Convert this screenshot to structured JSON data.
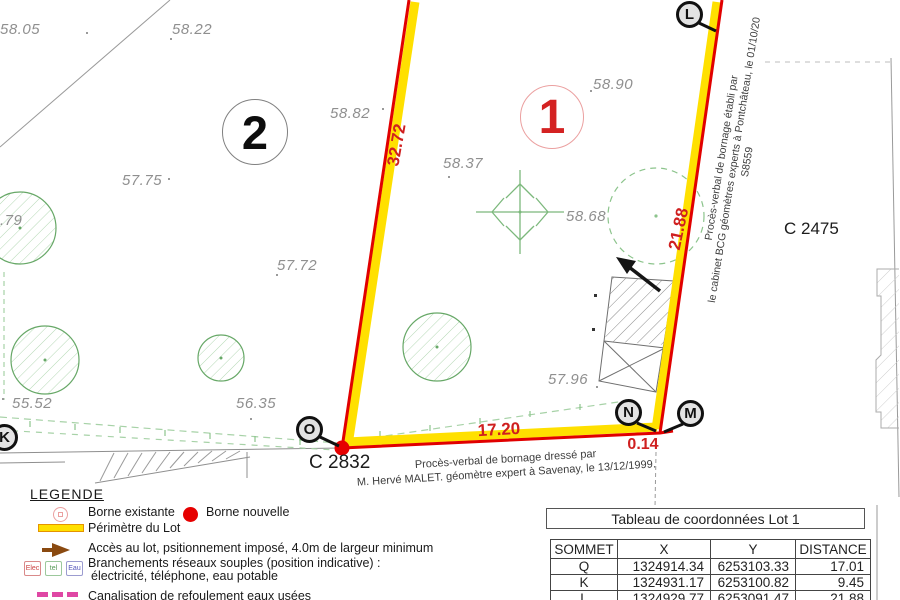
{
  "plan": {
    "lot1_label": "1",
    "lot2_label": "2",
    "parcel_right": "C 2475",
    "parcel_bottom": "C 2832",
    "dim_left": "32.72",
    "dim_right": "21.88",
    "dim_bottom": "17.20",
    "dim_corner": "0.14",
    "vertices": {
      "L": "L",
      "O": "O",
      "N": "N",
      "M": "M",
      "K": "K"
    },
    "elevations": [
      {
        "value": "58.05"
      },
      {
        "value": "58.22"
      },
      {
        "value": "58.90"
      },
      {
        "value": "58.82"
      },
      {
        "value": "58.37"
      },
      {
        "value": "58.68"
      },
      {
        "value": "57.75"
      },
      {
        "value": "57.72"
      },
      {
        "value": ".79"
      },
      {
        "value": "55.52"
      },
      {
        "value": "56.35"
      },
      {
        "value": "57.96"
      }
    ],
    "note_right": {
      "line1": "Procès-verbal de bornage établi par",
      "line2": "le cabinet BCG géomètres experts à Pontchâteau, le 01/10/20",
      "line3": "S8559"
    },
    "note_bottom": {
      "line1": "Procès-verbal de bornage dressé par",
      "line2": "M. Hervé MALET. géomètre expert à Savenay, le 13/12/1999."
    }
  },
  "legend": {
    "title": "LEGENDE",
    "borne_existante": "Borne existante",
    "borne_nouvelle": "Borne nouvelle",
    "perimetre": "Périmètre du Lot",
    "acces": "Accès au lot, psitionnement imposé, 4.0m de largeur minimum",
    "branchements_line1": "Branchements réseaux souples (position indicative) :",
    "branchements_line2": "électricité, téléphone, eau potable",
    "canalisation": "Canalisation de refoulement eaux usées",
    "box_elec": "Elec",
    "box_tel": "tel",
    "box_eau": "Eau"
  },
  "table": {
    "title": "Tableau de coordonnées Lot 1",
    "headers": [
      "SOMMET",
      "X",
      "Y",
      "DISTANCE"
    ],
    "rows": [
      {
        "sommet": "Q",
        "x": "1324914.34",
        "y": "6253103.33",
        "distance": "17.01"
      },
      {
        "sommet": "K",
        "x": "1324931.17",
        "y": "6253100.82",
        "distance": "9.45"
      },
      {
        "sommet": "L",
        "x": "1324929.77",
        "y": "6253091.47",
        "distance": "21.88"
      }
    ]
  },
  "colors": {
    "perimeter_red": "#e10000",
    "perimeter_yellow": "#ffe000",
    "dimension_red": "#cf1f1f",
    "vegetation_green": "#67a867",
    "borne_nouvelle_red": "#e60000",
    "canalisation_magenta": "#df47a4",
    "acces_brown": "#8a4a10"
  }
}
